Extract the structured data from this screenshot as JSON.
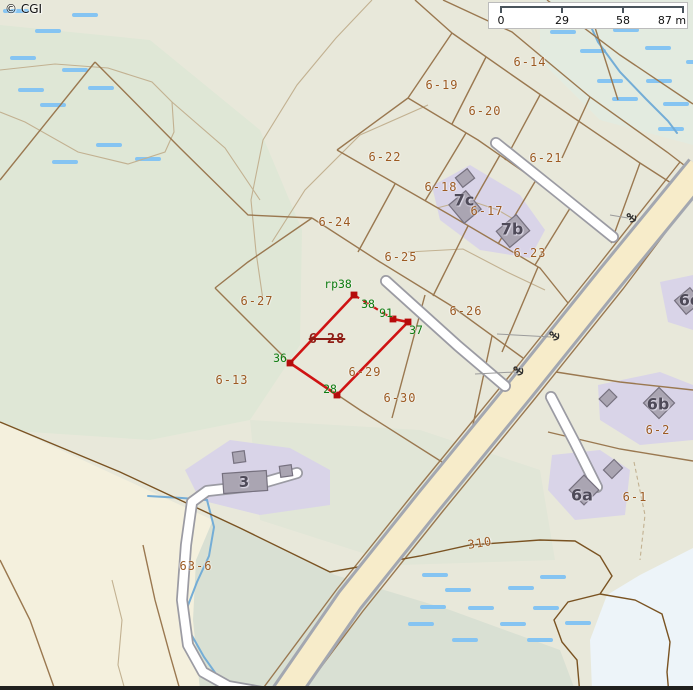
{
  "map": {
    "copyright": "© CGI",
    "scalebar": {
      "unit": "m",
      "ticks": [
        {
          "label": "0"
        },
        {
          "label": "29"
        },
        {
          "label": "58"
        },
        {
          "label": "87 m"
        }
      ]
    },
    "labels": {
      "parcels": [
        {
          "t": "6-14",
          "x": 530,
          "y": 62
        },
        {
          "t": "6-19",
          "x": 442,
          "y": 85
        },
        {
          "t": "6-20",
          "x": 485,
          "y": 111
        },
        {
          "t": "6-22",
          "x": 385,
          "y": 157
        },
        {
          "t": "6-21",
          "x": 546,
          "y": 158
        },
        {
          "t": "6-18",
          "x": 441,
          "y": 187
        },
        {
          "t": "6-17",
          "x": 487,
          "y": 211
        },
        {
          "t": "6-24",
          "x": 335,
          "y": 222
        },
        {
          "t": "6-23",
          "x": 530,
          "y": 253
        },
        {
          "t": "6-25",
          "x": 401,
          "y": 257
        },
        {
          "t": "6-27",
          "x": 257,
          "y": 301
        },
        {
          "t": "6-26",
          "x": 466,
          "y": 311
        },
        {
          "t": "6-29",
          "x": 365,
          "y": 372
        },
        {
          "t": "6-13",
          "x": 232,
          "y": 380
        },
        {
          "t": "6-30",
          "x": 400,
          "y": 398
        },
        {
          "t": "6-2",
          "x": 658,
          "y": 430
        },
        {
          "t": "6-1",
          "x": 635,
          "y": 497
        },
        {
          "t": "63-6",
          "x": 196,
          "y": 566
        },
        {
          "t": "310",
          "x": 480,
          "y": 543,
          "rot": -9
        }
      ],
      "buildings": [
        {
          "t": "7c",
          "x": 464,
          "y": 200
        },
        {
          "t": "7b",
          "x": 512,
          "y": 229
        },
        {
          "t": "6b",
          "x": 658,
          "y": 404
        },
        {
          "t": "6a",
          "x": 582,
          "y": 495
        },
        {
          "t": "3",
          "x": 244,
          "y": 482,
          "s": 15
        },
        {
          "t": "6c",
          "x": 689,
          "y": 300
        }
      ],
      "survey_points": [
        {
          "t": "rp38",
          "x": 338,
          "y": 284
        },
        {
          "t": "38",
          "x": 368,
          "y": 304
        },
        {
          "t": "91",
          "x": 386,
          "y": 313
        },
        {
          "t": "37",
          "x": 416,
          "y": 330
        },
        {
          "t": "36",
          "x": 280,
          "y": 358
        },
        {
          "t": "28",
          "x": 330,
          "y": 389
        }
      ],
      "highlighted_parcel": {
        "t": "6-28",
        "x": 327,
        "y": 339
      }
    },
    "colors": {
      "base": "#e8e8da",
      "green_forest": "#dfe7d6",
      "green_low": "#d9e0d3",
      "green_center": "#e1e6d7",
      "wet_bg": "#e3ebe0",
      "cream": "#f4f0dd",
      "water": "#edf4f9",
      "lavender": "#d9d4e8",
      "wet_bar": "#85c4f2",
      "stream": "#74add6",
      "contour": "#c2b191",
      "cadastral_brown": "#9a7850",
      "dark_brown": "#7a5322",
      "white_road_fill": "#ffffff",
      "white_road_casing": "#9b9ba3",
      "highway_fill": "#f7ecca",
      "highway_casing": "#a3a7b0",
      "building_fill": "#aaa5b2",
      "building_stroke": "#76717f",
      "grey_line": "#9b9b9b",
      "highlight_red": "#cf1313",
      "vertex_red": "#b50b0b",
      "anchor_symbol": "#2f2f2f",
      "scalebar_line": "#4a545c"
    }
  }
}
